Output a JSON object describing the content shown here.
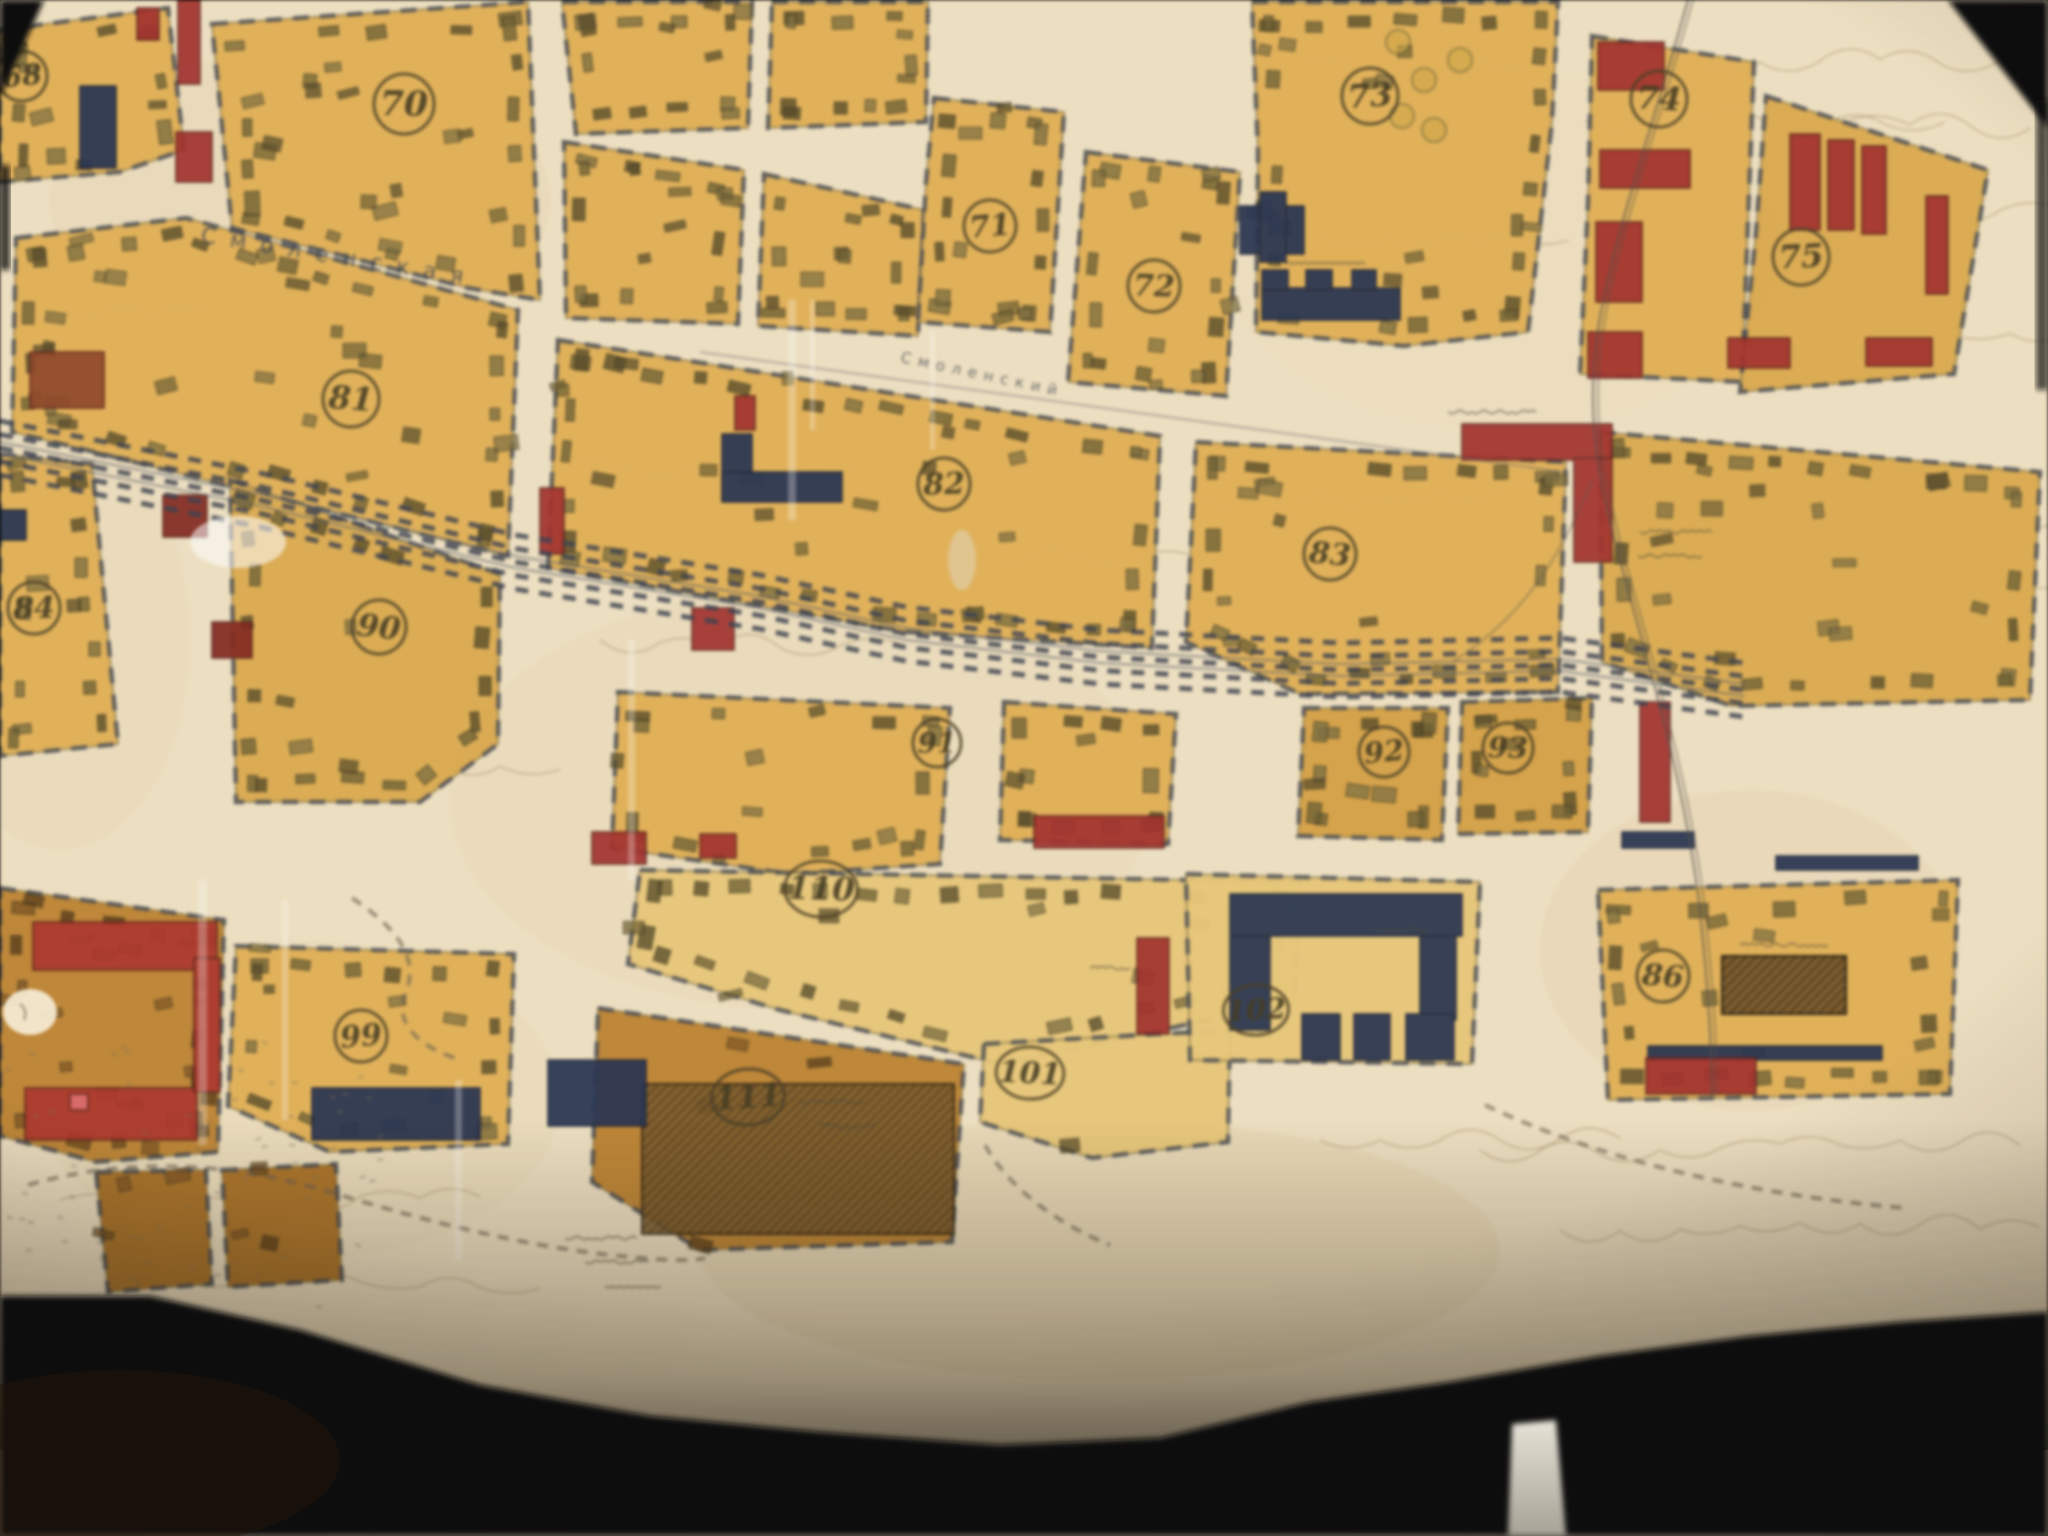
{
  "map": {
    "street_names": [
      {
        "id": "smolenskaya",
        "text": "Смоленская"
      },
      {
        "id": "smolensky",
        "text": "Смоленский"
      }
    ],
    "block_numbers": [
      {
        "id": "n68",
        "label": "68",
        "x": 22,
        "y": 76,
        "r": 25
      },
      {
        "id": "n70",
        "label": "70",
        "x": 404,
        "y": 104,
        "r": 30
      },
      {
        "id": "n71",
        "label": "71",
        "x": 990,
        "y": 226,
        "r": 26
      },
      {
        "id": "n72",
        "label": "72",
        "x": 1154,
        "y": 286,
        "r": 26
      },
      {
        "id": "n73",
        "label": "73",
        "x": 1370,
        "y": 96,
        "r": 28
      },
      {
        "id": "n74",
        "label": "74",
        "x": 1659,
        "y": 99,
        "r": 28
      },
      {
        "id": "n75",
        "label": "75",
        "x": 1801,
        "y": 257,
        "r": 28
      },
      {
        "id": "n81",
        "label": "81",
        "x": 351,
        "y": 399,
        "r": 28
      },
      {
        "id": "n82",
        "label": "82",
        "x": 944,
        "y": 484,
        "r": 26
      },
      {
        "id": "n83",
        "label": "83",
        "x": 1330,
        "y": 554,
        "r": 26
      },
      {
        "id": "n84",
        "label": "84",
        "x": 34,
        "y": 608,
        "r": 26
      },
      {
        "id": "n90",
        "label": "90",
        "x": 379,
        "y": 627,
        "r": 27
      },
      {
        "id": "n91",
        "label": "91",
        "x": 937,
        "y": 743,
        "r": 24
      },
      {
        "id": "n92",
        "label": "92",
        "x": 1384,
        "y": 752,
        "r": 25
      },
      {
        "id": "n93",
        "label": "93",
        "x": 1508,
        "y": 748,
        "r": 25
      },
      {
        "id": "n99",
        "label": "99",
        "x": 361,
        "y": 1036,
        "r": 26
      },
      {
        "id": "n110",
        "label": "110",
        "x": 821,
        "y": 889,
        "r": 28
      },
      {
        "id": "n111",
        "label": "111",
        "x": 748,
        "y": 1097,
        "r": 28
      },
      {
        "id": "n101",
        "label": "101",
        "x": 1030,
        "y": 1073,
        "r": 26
      },
      {
        "id": "n102",
        "label": "102",
        "x": 1256,
        "y": 1010,
        "r": 25
      },
      {
        "id": "n86",
        "label": "86",
        "x": 1663,
        "y": 976,
        "r": 26
      }
    ],
    "palette": {
      "paper": "#ecdfc2",
      "street": "#f0e6cf",
      "block": "#dfb15c",
      "block_alt": "#d9ab55",
      "block_dense": "#d2a24c",
      "block_pale": "#e6c87e",
      "block_brown": "#bb8438",
      "block_brown2": "#a8722c",
      "building": "#6e6238",
      "building_dark": "#564c2c",
      "building_lt": "#7d7045",
      "navy": "#2a3550",
      "red": "#9e3430",
      "maroon": "#7e2a22",
      "ink": "#4a4028",
      "track": "#3d4350",
      "pencil": "#6b6152",
      "contour": "#8f7d54"
    }
  }
}
